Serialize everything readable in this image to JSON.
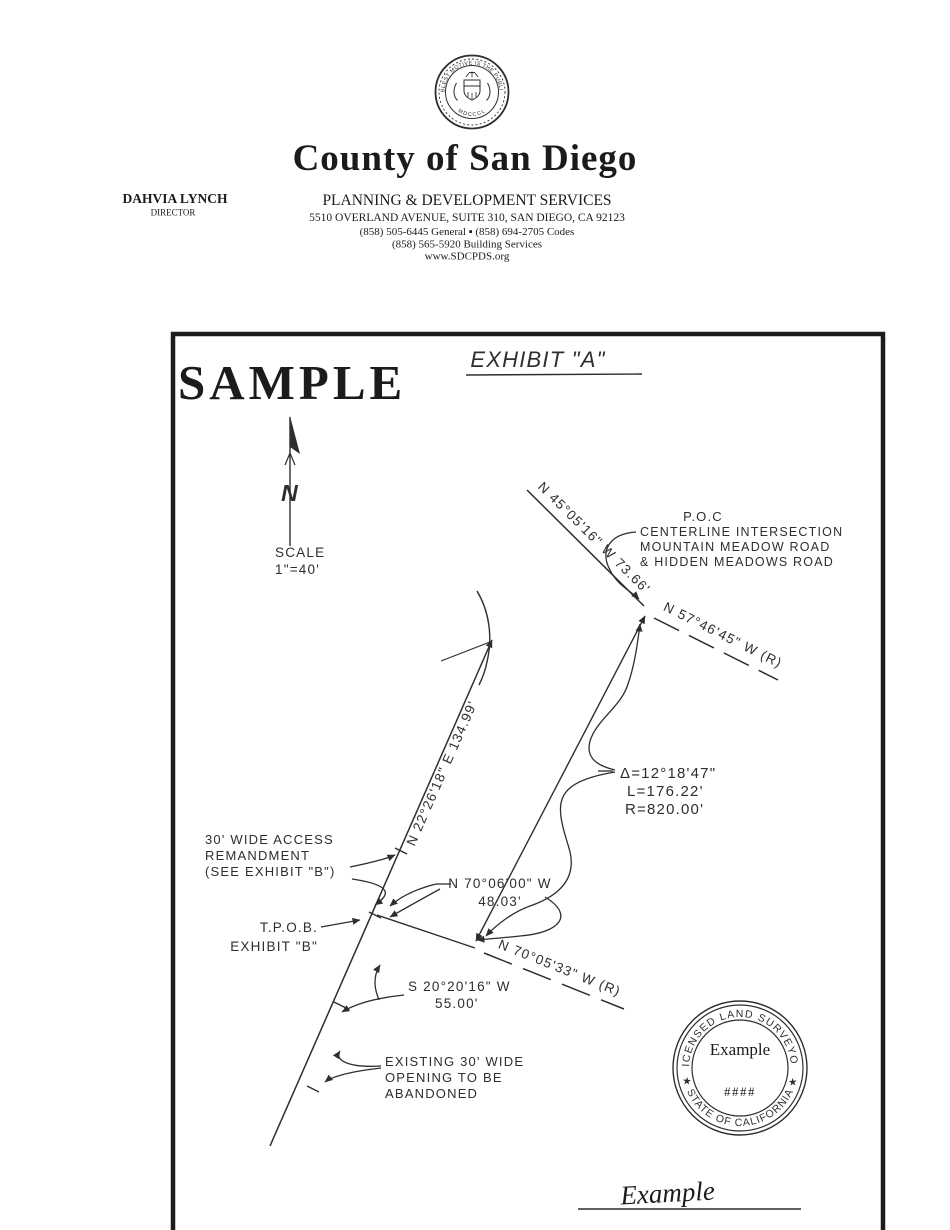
{
  "colors": {
    "ink": "#2e2e2e",
    "header_ink": "#1b1b1b",
    "watermark": "#3a3a3a"
  },
  "header": {
    "seal_motto": "THE NOBLEST MOTIVE IS THE PUBLIC GOOD",
    "seal_year": "MDCCCL",
    "wordmark": "County of San Diego",
    "director_name": "DAHVIA LYNCH",
    "director_title": "DIRECTOR",
    "department": "PLANNING & DEVELOPMENT SERVICES",
    "address": "5510 OVERLAND AVENUE, SUITE 310, SAN DIEGO, CA 92123",
    "phones": "(858) 505-6445 General ▪ (858) 694-2705 Codes",
    "building_services": "(858) 565-5920 Building Services",
    "website": "www.SDCPDS.org"
  },
  "exhibit": {
    "watermark": "SAMPLE",
    "title": "EXHIBIT  \"A\"",
    "north_symbol": "N",
    "scale_label": "SCALE",
    "scale_value": "1\"=40'",
    "poc_title": "P.O.C",
    "poc_lines": [
      "CENTERLINE  INTERSECTION",
      "MOUNTAIN  MEADOW  ROAD",
      "&  HIDDEN  MEADOWS  ROAD"
    ],
    "bearing_poc_line": "N 45°05'16\" W  73.66'",
    "bearing_record_upper": "N  57°46'45\"  W  (R)",
    "bearing_main_line": "N 22°26'18\" E  134.99'",
    "curve_delta": "Δ=12°18'47\"",
    "curve_length": "L=176.22'",
    "curve_radius": "R=820.00'",
    "access_lines": [
      "30'  WIDE  ACCESS",
      "REMANDMENT",
      "(SEE  EXHIBIT  \"B\")"
    ],
    "tpob_lines": [
      "T.P.O.B.",
      "EXHIBIT  \"B\""
    ],
    "bearing_short": "N  70°06'00\"  W",
    "bearing_short_dist": "48.03'",
    "bearing_record_lower": "N  70°05'33\"  W  (R)",
    "bearing_south": "S  20°20'16\"  W",
    "bearing_south_dist": "55.00'",
    "abandon_lines": [
      "EXISTING  30'  WIDE",
      "OPENING  TO  BE",
      "ABANDONED"
    ],
    "surveyor_seal": {
      "arc_top": "LICENSED LAND SURVEYOR",
      "arc_bottom": "★ STATE OF CALIFORNIA ★",
      "name": "Example",
      "license": "####"
    },
    "signature": "Example"
  }
}
